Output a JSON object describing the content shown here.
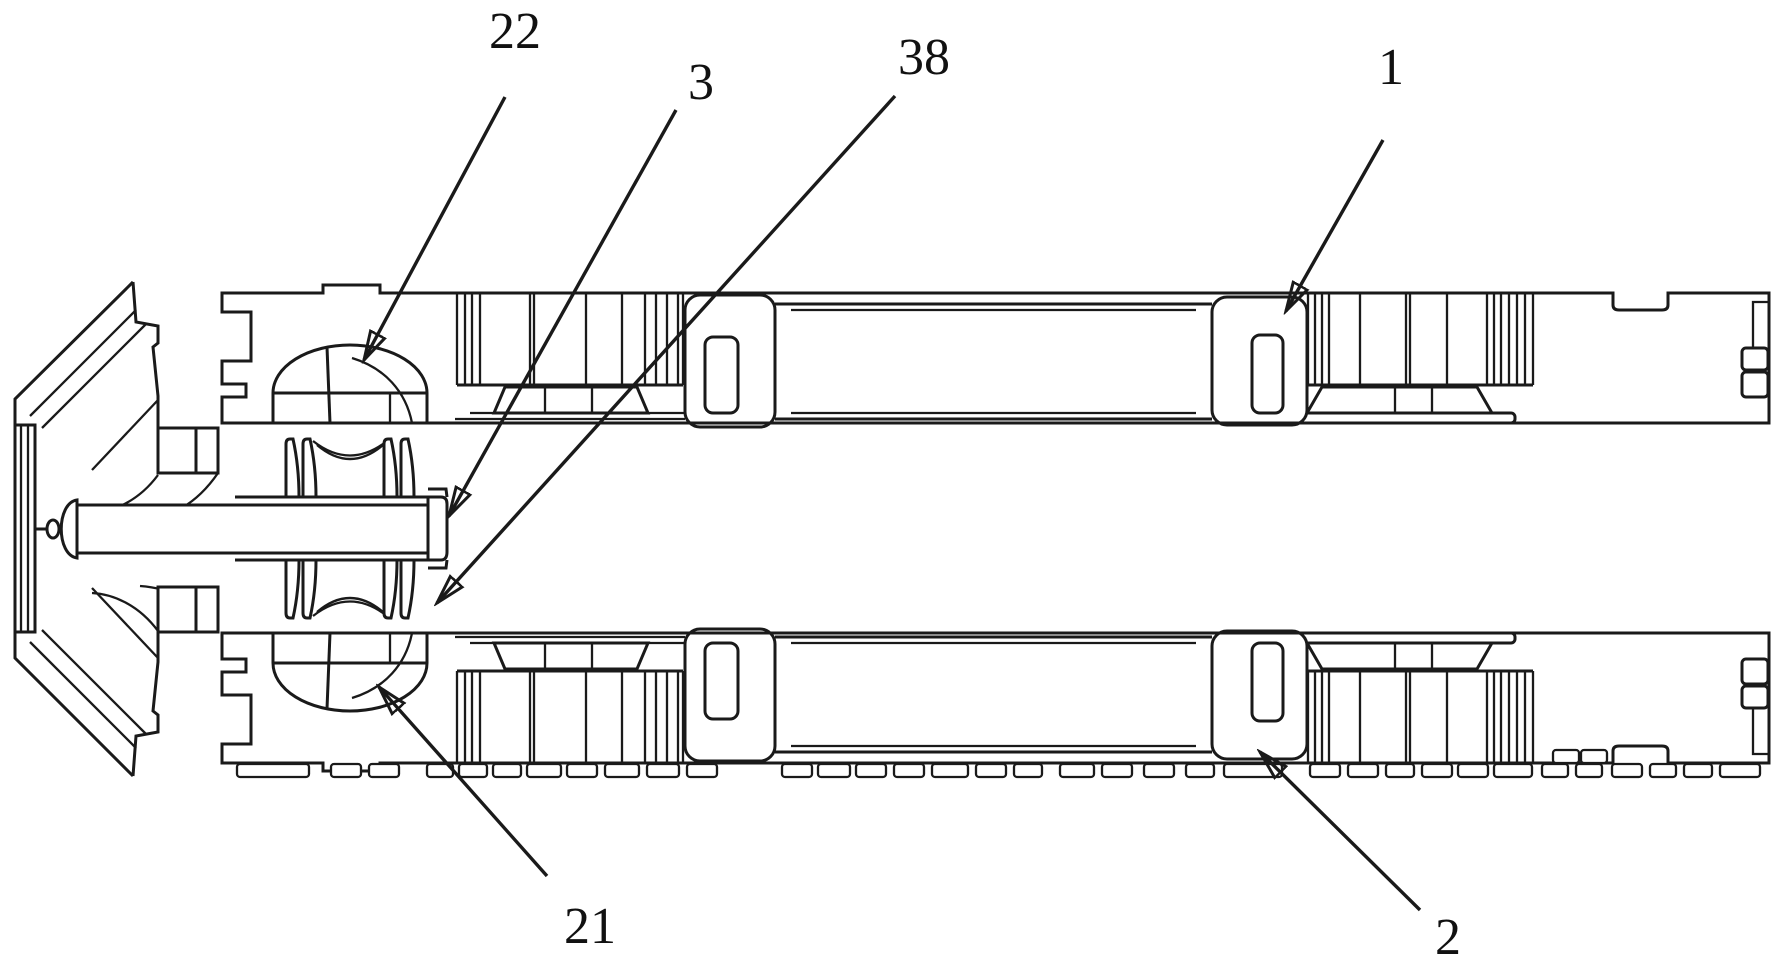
{
  "figure": {
    "colors": {
      "background": "#ffffff",
      "line": "#1a1a1a",
      "label": "#111111"
    },
    "labels": [
      {
        "text": "22",
        "x": 515,
        "y": 30,
        "leader": {
          "x1": 505,
          "y1": 97,
          "x2": 364,
          "y2": 360
        }
      },
      {
        "text": "3",
        "x": 701,
        "y": 81,
        "leader": {
          "x1": 676,
          "y1": 110,
          "x2": 449,
          "y2": 516
        }
      },
      {
        "text": "38",
        "x": 924,
        "y": 56,
        "leader": {
          "x1": 895,
          "y1": 96,
          "x2": 437,
          "y2": 603
        }
      },
      {
        "text": "1",
        "x": 1391,
        "y": 66,
        "leader": {
          "x1": 1383,
          "y1": 140,
          "x2": 1286,
          "y2": 311
        }
      },
      {
        "text": "21",
        "x": 590,
        "y": 925,
        "leader": {
          "x1": 547,
          "y1": 876,
          "x2": 379,
          "y2": 687
        }
      },
      {
        "text": "2",
        "x": 1448,
        "y": 936,
        "leader": {
          "x1": 1420,
          "y1": 910,
          "x2": 1260,
          "y2": 752
        }
      }
    ],
    "hatch_groups": [
      {
        "x_lines": [
          457,
          465,
          472,
          480,
          530,
          534,
          586,
          622,
          645,
          656,
          667,
          678,
          683
        ],
        "y_top": 294,
        "y_bottom": 385
      },
      {
        "x_lines": [
          1308,
          1315,
          1322,
          1329,
          1360,
          1406,
          1410,
          1447,
          1487,
          1494,
          1501,
          1509,
          1517,
          1525,
          1533
        ],
        "y_top": 294,
        "y_bottom": 385
      }
    ],
    "feet": [
      [
        237,
        72
      ],
      [
        331,
        30
      ],
      [
        369,
        30
      ],
      [
        427,
        26
      ],
      [
        459,
        28
      ],
      [
        493,
        28
      ],
      [
        527,
        34
      ],
      [
        567,
        30
      ],
      [
        605,
        34
      ],
      [
        647,
        32
      ],
      [
        687,
        30
      ],
      [
        782,
        30
      ],
      [
        818,
        32
      ],
      [
        856,
        30
      ],
      [
        894,
        30
      ],
      [
        932,
        36
      ],
      [
        976,
        30
      ],
      [
        1014,
        28
      ],
      [
        1060,
        34
      ],
      [
        1102,
        30
      ],
      [
        1144,
        30
      ],
      [
        1186,
        28
      ],
      [
        1224,
        58
      ],
      [
        1310,
        30
      ],
      [
        1348,
        30
      ],
      [
        1386,
        28
      ],
      [
        1422,
        30
      ],
      [
        1458,
        30
      ],
      [
        1494,
        38
      ],
      [
        1542,
        26
      ],
      [
        1576,
        26
      ],
      [
        1612,
        30
      ],
      [
        1650,
        26
      ],
      [
        1684,
        28
      ],
      [
        1720,
        40
      ]
    ],
    "corner_blocks": [
      [
        1553,
        750,
        26,
        13
      ],
      [
        1581,
        750,
        26,
        13
      ]
    ],
    "roller_blade_x": [
      286,
      303,
      384,
      401
    ]
  }
}
